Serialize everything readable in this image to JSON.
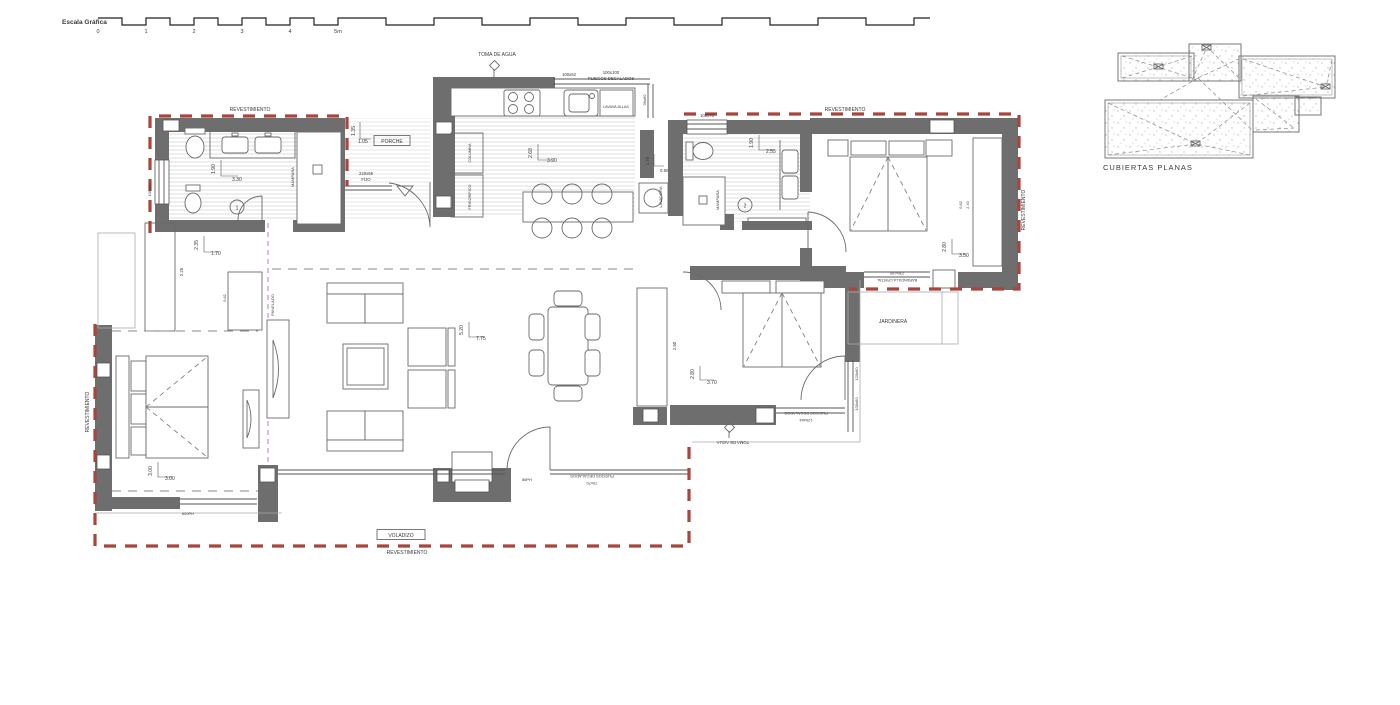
{
  "colors": {
    "wall": "#6e6e6e",
    "cladding_dash": "#a8453c",
    "panel_dash": "#cf9fd0"
  },
  "scalebar": {
    "title": "Escala Gráfica",
    "ticks": [
      "0",
      "1",
      "2",
      "3",
      "4",
      "5m"
    ]
  },
  "roof": {
    "title": "CUBIERTAS PLANAS"
  },
  "labels": {
    "revestimiento": "REVESTIMIENTO",
    "toma_de_agua": "TOMA DE AGUA",
    "porche": "PORCHE",
    "fijo_size": "220x65",
    "fijo": "FIJO",
    "lavavajillas": "LAVAVAJILLAS",
    "lavadora": "LAVADORA",
    "mampara": "MAMPARA",
    "panelado": "PANELADO",
    "jardinera": "JARDINERA",
    "voladizo": "VOLADIZO",
    "barandilla_size": "230x100",
    "barandilla": "BARANDILLA CRISTAL",
    "pliegos": "PLIEGOS DECALADOS",
    "columna": "COLUMNA",
    "frigorifico": "FRIGORIFICO"
  },
  "windows": {
    "kitchen_small": "100x62",
    "kitchen_big": "100x100",
    "kitchen_side": "35x60",
    "bath1_side": "100x65",
    "bath2_top": "100x70",
    "bed2_right_a": "120x60",
    "bed2_right_b": "100x60",
    "bed2_bottom": "120x64",
    "living_bottom": "70x70",
    "living_door": "86PH",
    "bed3_bottom": "600PH",
    "wardrobe_depth": "0.62",
    "wardrobe_len": "2.40"
  },
  "dims": {
    "bath1_v": "1.90",
    "bath1_h": "3.30",
    "hall_v": "2.35",
    "hall_h": "1.70",
    "hall_ward": "2.25",
    "hall_ward2": "0.62",
    "kitchen_v": "2.68",
    "kitchen_h": "3.90",
    "niche_v": "1.70",
    "niche_h": "0.80",
    "bath2_v": "1.90",
    "bath2_h": "2.55",
    "bed1_v": "2.80",
    "bed1_h": "3.50",
    "bed2_v": "2.80",
    "bed2_h": "3.70",
    "bed3_v": "3.00",
    "bed3_h": "3.00",
    "living_v": "5.20",
    "living_h": "7.75",
    "ward2": "2.50",
    "porch_h": "1.05",
    "porch_v": "1.35"
  },
  "rooms": {
    "bath1_num": "1",
    "bath2_num": "2"
  }
}
